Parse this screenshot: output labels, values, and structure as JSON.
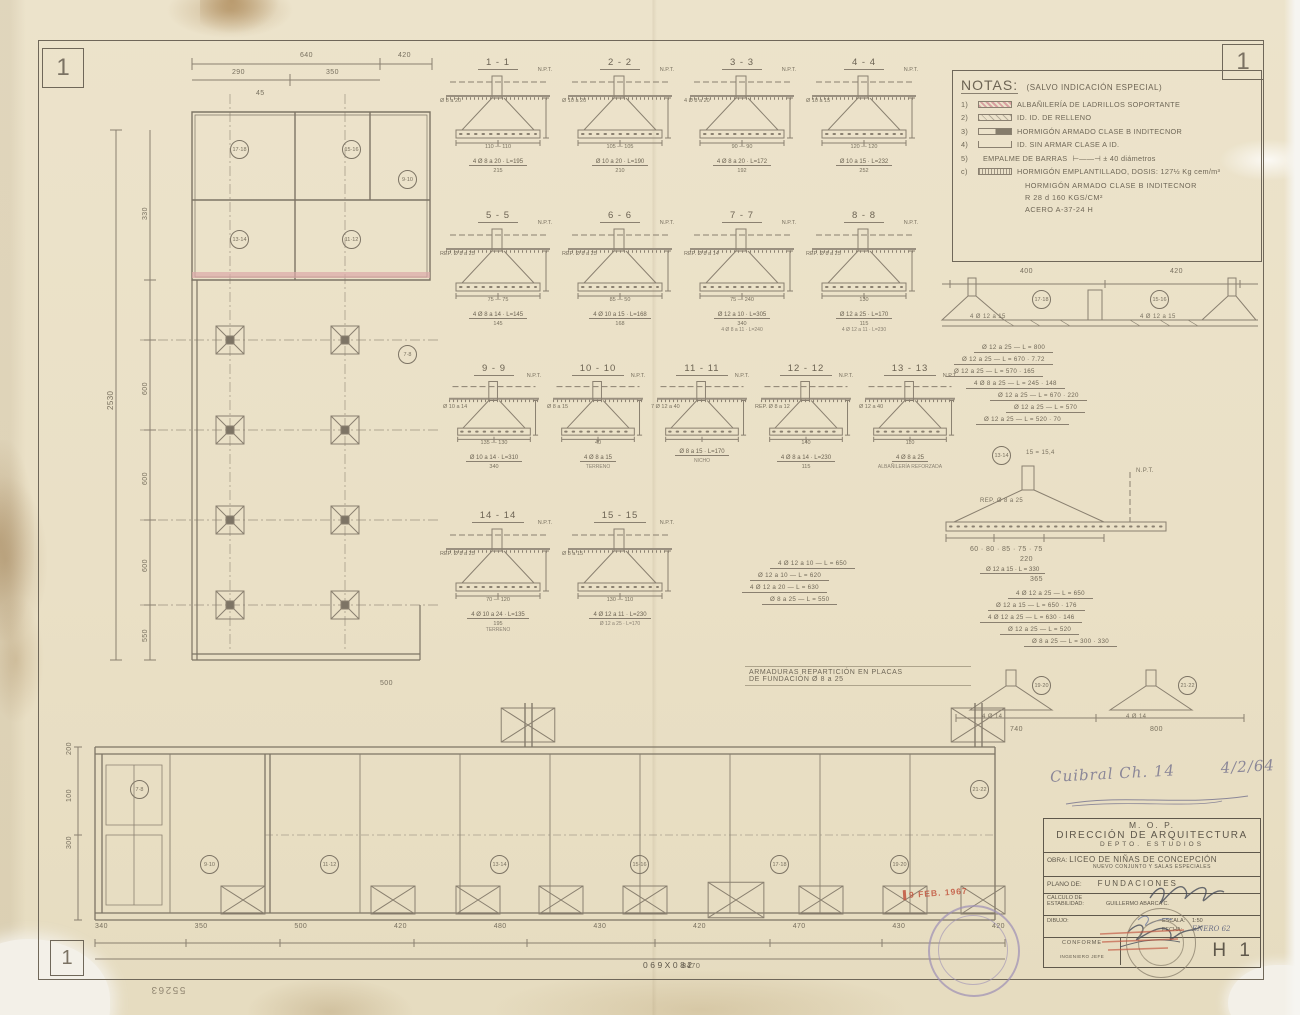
{
  "page": {
    "corner_label": "1"
  },
  "colors": {
    "paper": "#eae0c6",
    "pencil": "#8a8070",
    "ink": "#5f584b",
    "red_stamp": "#c2553f",
    "purple_stamp": "#9d8fb5",
    "pink_hatch": "#d8a0a0"
  },
  "notes": {
    "title": "NOTAS:",
    "subtitle": "(SALVO INDICACIÓN ESPECIAL)",
    "items": [
      {
        "n": "1)",
        "t": "ALBAÑILERÍA DE LADRILLOS SOPORTANTE",
        "x": "",
        "sw": "pink"
      },
      {
        "n": "2)",
        "t": "ID.            ID.            DE RELLENO",
        "x": "",
        "sw": "light"
      },
      {
        "n": "3)",
        "t": "HORMIGÓN ARMADO CLASE B INDITECNOR",
        "x": "",
        "sw": "dark"
      },
      {
        "n": "4)",
        "t": "ID.     SIN ARMAR CLASE A        ID.",
        "x": "",
        "sw": "open"
      },
      {
        "n": "5)",
        "t": "EMPALME DE BARRAS",
        "x": "⊢——⊣  ± 40 diámetros",
        "sw": "none"
      },
      {
        "n": "c)",
        "t": "HORMIGÓN EMPLANTILLADO, DOSIS: 127½ Kg cem/m³",
        "x": "",
        "sw": "dense"
      }
    ],
    "footer": [
      "HORMIGÓN ARMADO CLASE B INDITECNOR",
      "R 28 d     160 KGS/CM²",
      "ACERO   A-37-24 H"
    ]
  },
  "sections": {
    "npt": "N.P.T.",
    "row1": [
      {
        "label": "1 - 1",
        "note": "Ø 8 a 20",
        "dims": "110 — 110",
        "bar": "4 Ø 8 a 20 · L=195",
        "total": "215",
        "extra": ""
      },
      {
        "label": "2 - 2",
        "note": "Ø 10 a 20",
        "dims": "105 — 105",
        "bar": "Ø 10 a 20 · L=190",
        "total": "210",
        "extra": ""
      },
      {
        "label": "3 - 3",
        "note": "4 Ø 8 a 20",
        "dims": "90 — 90",
        "bar": "4 Ø 8 a 20 · L=172",
        "total": "192",
        "extra": ""
      },
      {
        "label": "4 - 4",
        "note": "Ø 10 a 15",
        "dims": "120 — 120",
        "bar": "Ø 10 a 15 · L=232",
        "total": "252",
        "extra": ""
      }
    ],
    "row2": [
      {
        "label": "5 - 5",
        "note": "REP. Ø 8 a 25",
        "dims": "75 — 75",
        "bar": "4 Ø 8 a 14 · L=145",
        "total": "145",
        "extra": ""
      },
      {
        "label": "6 - 6",
        "note": "REP. Ø 8 a 25",
        "dims": "85 — 50",
        "bar": "4 Ø 10 a 15 · L=168",
        "total": "168",
        "extra": ""
      },
      {
        "label": "7 - 7",
        "note": "REP. Ø 8 a 14",
        "dims": "75 — 240",
        "bar": "Ø 12 a 10 · L=305",
        "total": "340",
        "extra": "4 Ø 8 a 11 · L=240"
      },
      {
        "label": "8 - 8",
        "note": "REP. Ø 8 a 25",
        "dims": "130",
        "bar": "Ø 12 a 25 · L=170",
        "total": "115",
        "extra": "4 Ø 12 a 11 · L=230"
      }
    ],
    "row3": [
      {
        "label": "9 - 9",
        "note": "Ø 10 a 14",
        "dims": "135 — 130",
        "bar": "Ø 10 a 14 · L=310",
        "total": "340",
        "extra": ""
      },
      {
        "label": "10 - 10",
        "note": "Ø 8 a 15",
        "dims": "40",
        "bar": "4 Ø 8 a 15",
        "total": "",
        "extra": "TERRENO"
      },
      {
        "label": "11 - 11",
        "note": "7 Ø 12 a 40",
        "dims": "",
        "bar": "Ø 8 a 15 · L=170",
        "total": "",
        "extra": "NICHO"
      },
      {
        "label": "12 - 12",
        "note": "REP. Ø 8 a 12",
        "dims": "140",
        "bar": "4 Ø 8 a 14 · L=230",
        "total": "115",
        "extra": ""
      },
      {
        "label": "13 - 13",
        "note": "Ø 12 a 40",
        "dims": "110",
        "bar": "4 Ø 8 a 25",
        "total": "",
        "extra": "ALBAÑILERÍA REFORZADA"
      }
    ],
    "row4": [
      {
        "label": "14 - 14",
        "note": "REP. Ø 8 a 25",
        "dims": "70 — 120",
        "bar": "4 Ø 10 a 24 · L=135",
        "total": "195",
        "extra": "TERRENO"
      },
      {
        "label": "15 - 15",
        "note": "Ø 8 a 15",
        "dims": "130 — 110",
        "bar": "4 Ø 12 a 11 · L=230",
        "total": "",
        "extra": "Ø 12 a 25 · L=170"
      }
    ]
  },
  "upper_plan": {
    "dim_640": "640",
    "dim_420": "420",
    "dim_290": "290",
    "dim_350": "350",
    "dim_45": "45",
    "dim_330": "330",
    "dim_600a": "600",
    "dim_600b": "600",
    "dim_600c": "600",
    "dim_550": "550",
    "total_left": "2530",
    "dim_500": "500",
    "refs": [
      "17·18",
      "15·16",
      "13·14",
      "11·12",
      "9·10",
      "7·8"
    ]
  },
  "lower_plan": {
    "dims": [
      "340",
      "350",
      "500",
      "420",
      "480",
      "430",
      "420",
      "470",
      "430",
      "420"
    ],
    "total": "8470",
    "stamp_number": "069X082",
    "left_dims": [
      "200",
      "100",
      "300"
    ],
    "refs": [
      "7·8",
      "9·10",
      "11·12",
      "13·14",
      "15·16",
      "17·18",
      "19·20",
      "21·22"
    ]
  },
  "armaduras_note": {
    "line1": "ARMADURAS REPARTICIÓN EN PLACAS",
    "line2": "DE FUNDACIÓN      Ø 8 a 25"
  },
  "elevations": {
    "dimA1": "400",
    "dimA2": "420",
    "refsA": [
      "17·18",
      "15·16"
    ],
    "barA_left": "4 Ø 12 a 15",
    "barA_right": "4 Ø 12 a 15",
    "schedule1": [
      "Ø 12 a 25 — L = 800",
      "Ø 12 a 25 — L = 670 · 7.72",
      "Ø 12 a 25 — L = 570 · 165",
      "4 Ø 8 a 25 — L = 245 · 148",
      "Ø 12 a 25 — L = 670 · 220",
      "Ø 12 a 25 — L = 570",
      "Ø 12 a 25 — L = 520 · 70"
    ],
    "refB": "13·14",
    "noteB": "15 = 15,4",
    "repB": "REP. Ø 8 a 25",
    "nptB": "N.P.T.",
    "dimsB": "60 · 80 · 85 · 75 · 75",
    "totalB": "220",
    "barB": "Ø 12 a 15 · L = 330",
    "totalB2": "365",
    "schedule2": [
      "4 Ø 12 a 25 — L = 650",
      "Ø 12 a 15 — L = 650 · 176",
      "4 Ø 12 a 25 — L = 630 · 146",
      "Ø 12 a 25 — L = 520",
      "Ø 8 a 25 — L = 300 · 330"
    ],
    "refsD": [
      "19·20",
      "21·22"
    ],
    "barD": "4 Ø 14",
    "barD2": "4 Ø 14",
    "dimsD1": "740",
    "dimsD2": "800",
    "schedule3": [
      "4 Ø 12 a 10 — L = 650",
      "Ø 12 a 10 — L = 620",
      "4 Ø 12 a 20 — L = 630",
      "Ø 8 a 25 — L = 550"
    ]
  },
  "annotation": {
    "text": "Cuibral Ch. 14",
    "date": "4/2/64"
  },
  "title_block": {
    "org1": "M. O. P.",
    "org2": "DIRECCIÓN DE ARQUITECTURA",
    "org3": "DEPTO. ESTUDIOS",
    "obra_label": "OBRA:",
    "obra_value": "LICEO DE NIÑAS DE CONCEPCIÓN",
    "obra_sub": "NUEVO CONJUNTO Y SALAS ESPECIALES",
    "plano_label": "PLANO DE:",
    "plano_value": "FUNDACIONES",
    "calculo_label1": "CALCULO DE",
    "calculo_label2": "ESTABILIDAD:",
    "calculo_value": "GUILLERMO ABARCA C.",
    "dibujo_label": "DIBUJO:",
    "escala_label": "ESCALA:",
    "escala_value": "1:50",
    "fecha_label": "FECHA:",
    "fecha_value": "ENERO 62",
    "conforme_label": "CONFORME",
    "conforme_sub": "INGENIERO JEFE",
    "sheet_code": "H 1"
  },
  "stamps": {
    "date_stamp": "9 FEB. 1967"
  },
  "margin_numbers": {
    "bottom_center": "069X082",
    "bottom_left": "55263"
  }
}
